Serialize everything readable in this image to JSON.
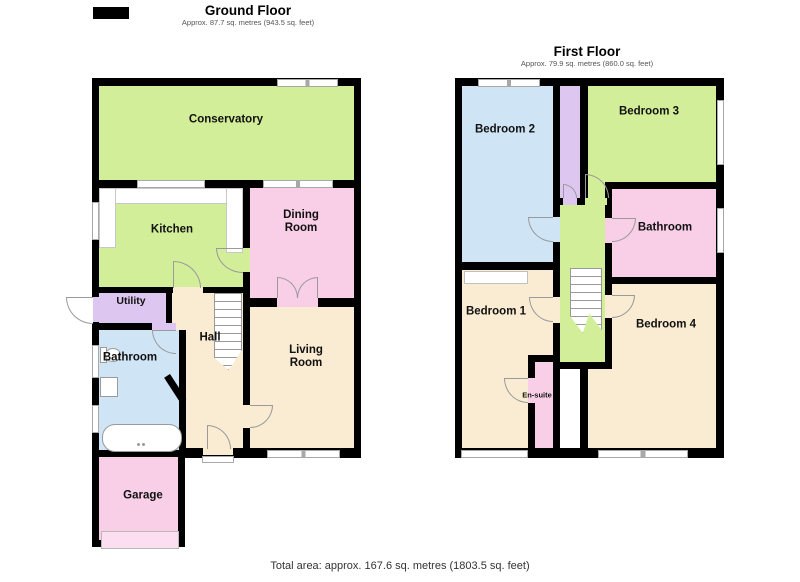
{
  "colors": {
    "wall": "#000000",
    "room_green": "#d3ee98",
    "room_pink": "#f8cfe7",
    "room_blue": "#cfe5f6",
    "room_cream": "#faecd2",
    "room_purple": "#ddc7f0",
    "garage_door_pink": "#fbdff0",
    "outline_gray": "#9a9a9a"
  },
  "ground_floor": {
    "title": "Ground Floor",
    "subtitle": "Approx. 87.7 sq. metres (943.5 sq. feet)",
    "rooms": {
      "conservatory": "Conservatory",
      "kitchen": "Kitchen",
      "dining_room": "Dining Room",
      "utility": "Utility",
      "hall": "Hall",
      "bathroom": "Bathroom",
      "living_room": "Living Room",
      "garage": "Garage"
    }
  },
  "first_floor": {
    "title": "First Floor",
    "subtitle": "Approx. 79.9 sq. metres (860.0 sq. feet)",
    "rooms": {
      "bedroom_2": "Bedroom 2",
      "bedroom_3": "Bedroom 3",
      "bathroom": "Bathroom",
      "bedroom_1": "Bedroom 1",
      "bedroom_4": "Bedroom 4",
      "en_suite": "En-suite"
    }
  },
  "footer": {
    "total_area": "Total area: approx. 167.6 sq. metres (1803.5 sq. feet)"
  }
}
